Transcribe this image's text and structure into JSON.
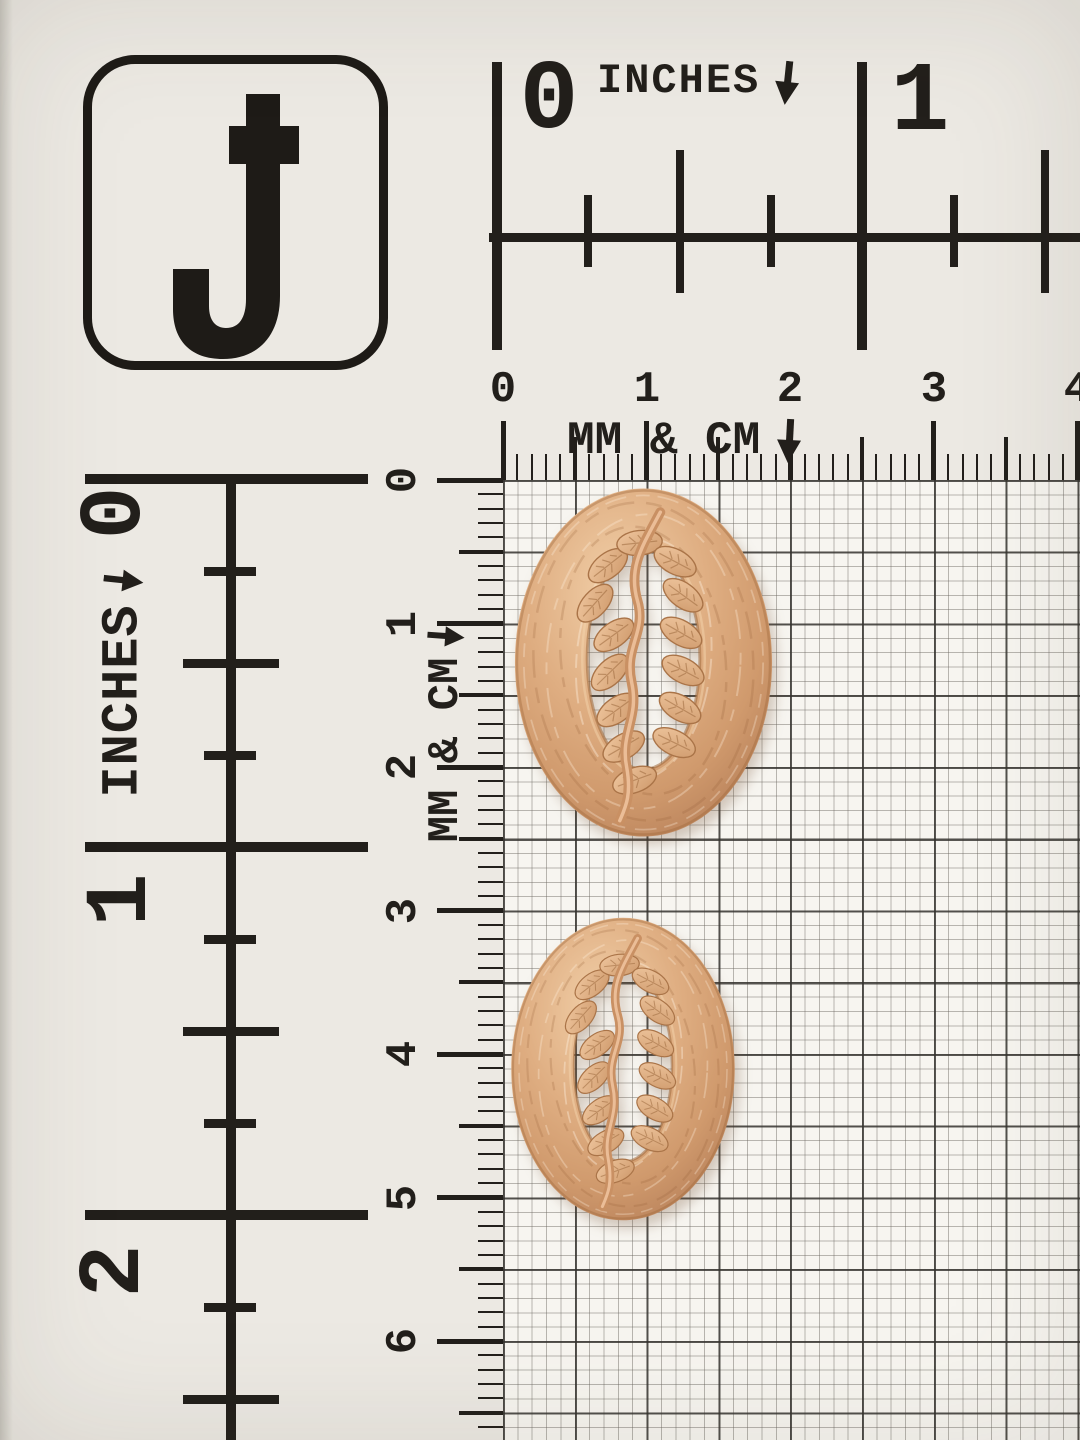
{
  "scene": {
    "description": "Product photo of two copper-tone oval leaf-vine buttons on a measuring grid card",
    "logo_letter": "J",
    "colors": {
      "ink": "#221f1b",
      "paper": "#ece9e3",
      "grid_paper": "#f7f5f0",
      "grid_line_light": "#8a867f",
      "grid_line_dark": "#3c3a36"
    }
  },
  "rulers": {
    "top_inches": {
      "title": "INCHES",
      "arrow_icon": "down-arrow",
      "labels": [
        "0",
        "1"
      ]
    },
    "top_mm_cm": {
      "title": "MM & CM",
      "arrow_icon": "down-arrow",
      "labels": [
        "0",
        "1",
        "2",
        "3",
        "4"
      ]
    },
    "left_inches": {
      "title": "INCHES",
      "arrow_icon": "right-arrow",
      "labels": [
        "0",
        "1",
        "2"
      ]
    },
    "left_mm_cm": {
      "title": "MM & CM",
      "arrow_icon": "right-arrow",
      "labels": [
        "0",
        "1",
        "2",
        "3",
        "4",
        "5",
        "6"
      ]
    }
  },
  "buttons": {
    "style": "oval ring button with embossed leaf vine across open center",
    "finish_colors": {
      "base": "#dcab7e",
      "highlight": "#f2d0a9",
      "shadow": "#b8815a"
    },
    "items": [
      {
        "name": "large oval leaf button"
      },
      {
        "name": "small oval leaf button"
      }
    ]
  }
}
